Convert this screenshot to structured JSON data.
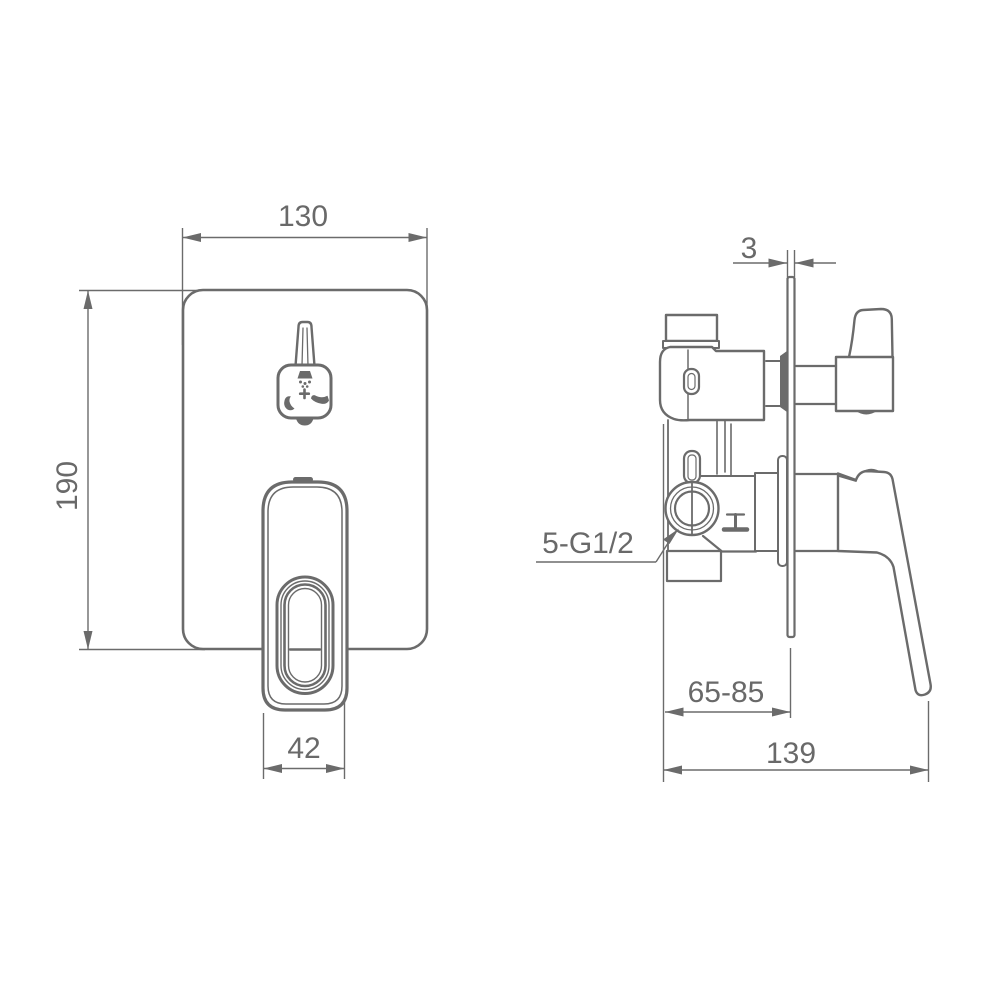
{
  "drawing": {
    "colors": {
      "line": "#6b6b6b",
      "text": "#696969",
      "background": "#ffffff"
    },
    "front_view": {
      "dim_width": "130",
      "dim_height": "190",
      "dim_handle_width": "42"
    },
    "side_view": {
      "dim_plate_thickness": "3",
      "dim_install_depth_range": "65-85",
      "dim_total_depth": "139",
      "label_thread_connections": "5-G1/2"
    }
  }
}
